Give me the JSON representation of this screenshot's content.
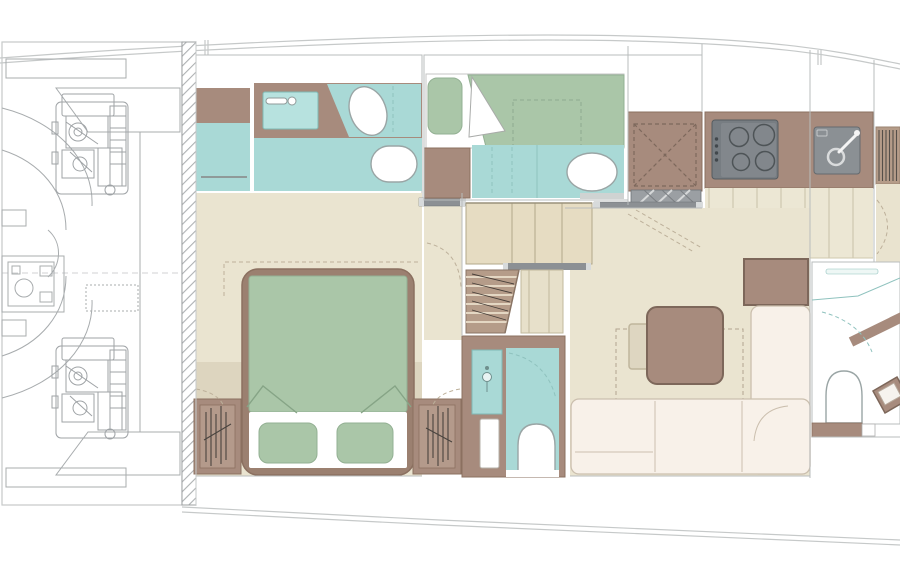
{
  "meta": {
    "title": "Yacht lower deck floor plan",
    "type": "floor-plan",
    "view": "top-down"
  },
  "colors": {
    "background": "#ffffff",
    "teal_floor": "#a9d9d6",
    "teal_fixture": "#b7e2df",
    "sage_green": "#aac6a8",
    "taupe": "#a78b7d",
    "taupe_dark": "#8b7060",
    "bed_frame": "#9b8070",
    "cream_floor": "#eae4d0",
    "cream_band": "#ddd5bf",
    "tan_cabinet": "#e6dcc2",
    "tan_cabinet_line": "#b1a78a",
    "plank_floor": "#ece7d4",
    "plank_line": "#c9c2a9",
    "sofa_cream": "#f8f1e9",
    "sofa_line": "#cbbfae",
    "appliance_gray": "#82878c",
    "appliance_dark": "#5f6569",
    "sink_gray": "#8b9094",
    "bar_gray": "#8c9094",
    "hatch_gray": "#9b9fa3",
    "line_gray": "#b9bcbc",
    "engine_line": "#a8acae",
    "hull_line": "#c6c9c9",
    "stair_brown": "#b59c89",
    "stair_line": "#8a7565",
    "fixture_outline": "#9aa5a5"
  },
  "rooms": [
    {
      "id": "engine-room",
      "features": [
        "port-engine",
        "starboard-engine",
        "generator",
        "tanks"
      ]
    },
    {
      "id": "master-bathroom",
      "features": [
        "vanity-sink",
        "faucet",
        "toilet",
        "bidet",
        "shower-screen",
        "towel-rail"
      ]
    },
    {
      "id": "master-cabin",
      "features": [
        "double-bed",
        "pillows-2",
        "wardrobe-port",
        "wardrobe-starboard"
      ]
    },
    {
      "id": "corridor",
      "features": [
        "sliding-door",
        "door-swing"
      ]
    },
    {
      "id": "guest-cabin",
      "features": [
        "single-berth",
        "pillow",
        "folded-sheet"
      ]
    },
    {
      "id": "guest-bathroom",
      "features": [
        "shower-tray",
        "toilet",
        "shower-screen"
      ]
    },
    {
      "id": "shower-room",
      "features": [
        "shower-tray-x",
        "grate"
      ]
    },
    {
      "id": "galley",
      "features": [
        "cooktop-4-burner",
        "sink",
        "faucet",
        "counter",
        "plank-floor"
      ]
    },
    {
      "id": "center-staircase",
      "features": [
        "treads",
        "cabinet",
        "handrail-bar"
      ]
    },
    {
      "id": "day-head",
      "features": [
        "washbasin-cabinet",
        "toilet",
        "door",
        "door-swing"
      ]
    },
    {
      "id": "salon",
      "features": [
        "dining-table",
        "chair",
        "l-sofa",
        "sideboard"
      ]
    },
    {
      "id": "aft-bathroom",
      "features": [
        "shelf",
        "toilet",
        "angled-vanity",
        "mirror-stripe"
      ]
    },
    {
      "id": "aft-staircase",
      "features": [
        "treads"
      ]
    }
  ],
  "bulkheads": [
    {
      "id": "engine-room-bulkhead",
      "style": "diagonal-hatch"
    }
  ]
}
